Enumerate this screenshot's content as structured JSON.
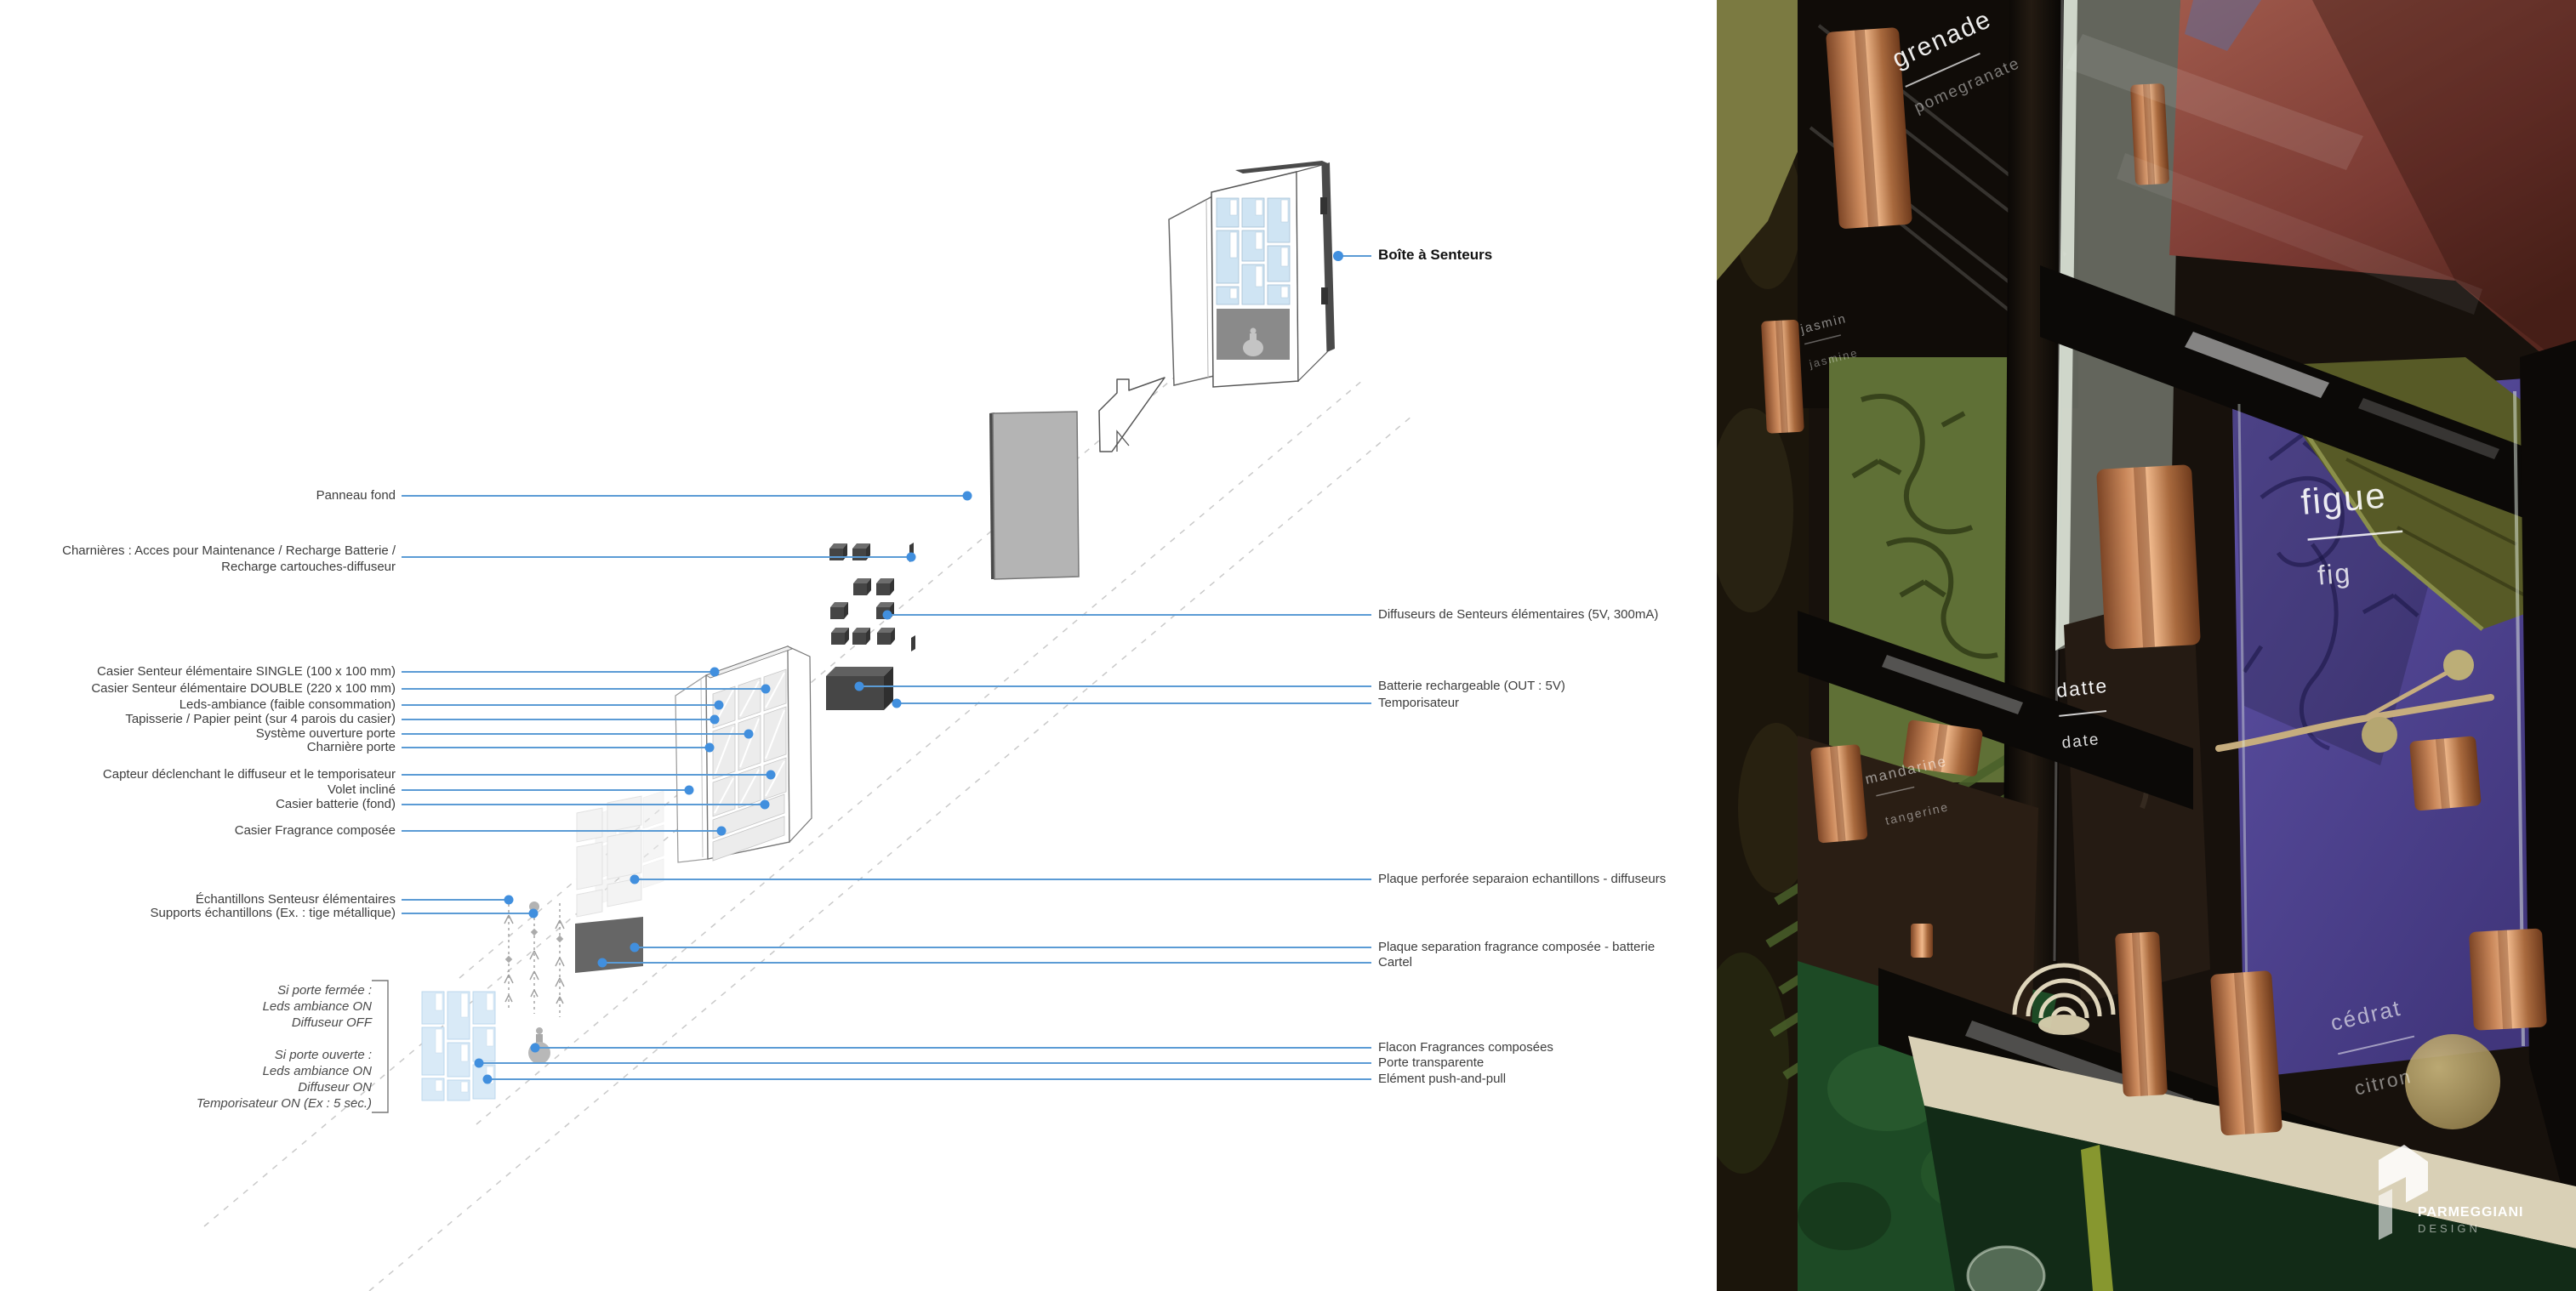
{
  "diagram": {
    "title": "Boîte à Senteurs",
    "left_labels": [
      "Panneau fond",
      "Charnières : Acces pour Maintenance / Recharge Batterie /\nRecharge cartouches-diffuseur",
      "Casier Senteur élémentaire SINGLE (100 x 100 mm)",
      "Casier Senteur élémentaire DOUBLE (220 x 100 mm)",
      "Leds-ambiance (faible consommation)",
      "Tapisserie / Papier peint (sur 4 parois du casier)",
      "Système ouverture porte",
      "Charnière porte",
      "Capteur déclenchant le diffuseur et le temporisateur",
      "Volet incliné",
      "Casier batterie (fond)",
      "Casier Fragrance composée",
      "Échantillons Senteusr élémentaires",
      "Supports échantillons (Ex. : tige métallique)"
    ],
    "right_labels": [
      "Diffuseurs de Senteurs élémentaires (5V, 300mA)",
      "Batterie rechargeable (OUT : 5V)",
      "Temporisateur",
      "Plaque perforée separaion echantillons - diffuseurs",
      "Plaque separation fragrance composée - batterie",
      "Cartel",
      "Flacon Fragrances composées",
      "Porte transparente",
      "Elément push-and-pull"
    ],
    "notes": "Si porte fermée :\nLeds ambiance ON\nDiffuseur OFF\n\nSi porte ouverte :\nLeds ambiance ON\nDiffuseur ON\nTemporisateur ON (Ex : 5 sec.)",
    "colors": {
      "callout_line": "#5b9bd5",
      "callout_dot": "#418fde"
    }
  },
  "photo": {
    "scent_labels": [
      {
        "fr": "grenade",
        "en": "pomegranate"
      },
      {
        "fr": "jasmin",
        "en": "jasmine"
      },
      {
        "fr": "figue",
        "en": "fig"
      },
      {
        "fr": "datte",
        "en": "date"
      },
      {
        "fr": "mandarine",
        "en": "tangerine"
      },
      {
        "fr": "cédrat",
        "en": "citron"
      }
    ],
    "logo": {
      "brand": "PARMEGGIANI",
      "division": "DESIGN"
    }
  }
}
